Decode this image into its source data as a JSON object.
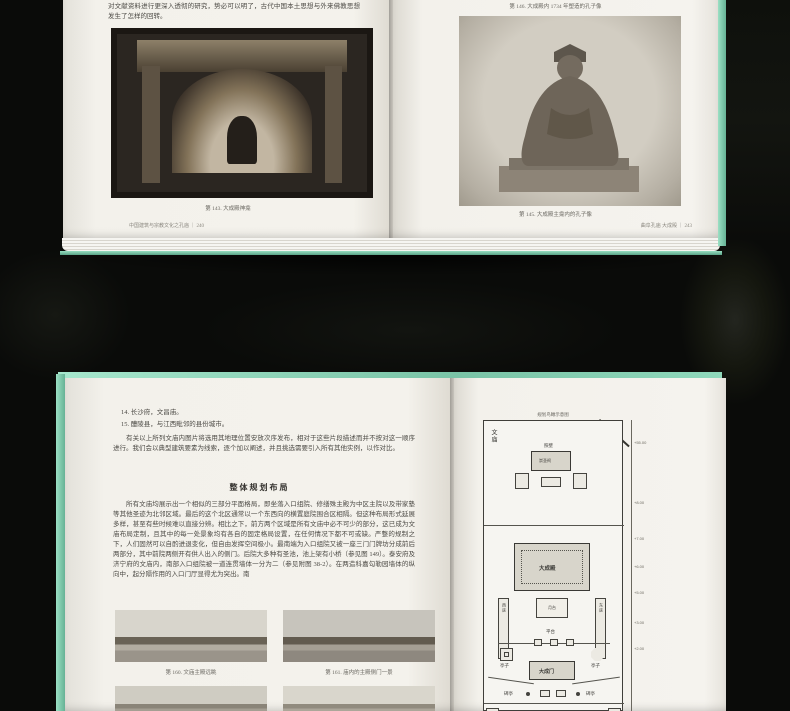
{
  "scene": {
    "background_color": "#0a0b09",
    "cover_color": "#8fd8bb",
    "page_color": "#f2f0ea"
  },
  "top_book": {
    "left_page": {
      "intro_text": "对文献资料进行更深入透彻的研究，势必可以明了，古代中国本土思想与外来佛教思想发生了怎样的回转。",
      "photo_caption": "第 143. 大成殿神龛",
      "footer": "中国建筑与宗教文化之孔庙 ｜ 240"
    },
    "right_page": {
      "top_caption": "第 146. 大成殿内 1734 年塑造的孔子像",
      "photo_caption": "第 145. 大成殿主龛内的孔子像",
      "footer": "曲阜孔庙 大成殿 ｜ 243"
    }
  },
  "bottom_book": {
    "left_page": {
      "list_items": [
        "14. 长沙府，文昌庙。",
        "15. 醴陵县，与江西毗邻的县份城市。"
      ],
      "intro_paragraph": "有关以上所列文庙内图片将选用其地理位置安放次序发布，相对于这些片段描述而并不按对这一顺序进行。我们会以典型建筑要素为线索，逐个加以阐述，并且挑选需要引入所有其他实例，以作对比。",
      "section_heading": "整体规划布局",
      "body_paragraph": "所有文庙均展示出一个相似的三部分平面格局，即坐落入口组院、修缮殊主殿为中区主院以及带家塾等其他圣迹为北邻区域。最后的这个北区通常以一个东西向的横置庭院围合区相隔。但这种布局形式延展多样，甚至有些时候难以直接分辨。相比之下，前方两个区域是所有文庙中必不可少的部分，这已成为文庙布局定制，且其中的每一处景象均有各自的固定格局设置，在任何情况下都不可或缺。严整的规制之下，人们固然可以自酌进退变化，但自由发挥空间极小。最南端为入口组院又被一座三门门牌坊分成前后两部分，其中前院两侧开有供人出入的侧门。后院大多种有圣池，池上架有小桥（参见图 149）。泰安府及济宁府的文庙内，南部入口组院被一道连贯墙体一分为二（参见附图 38-2）。在两造科嘉勾勒园墙体的纵向中，起分隔作用的入口门厅显得尤为突出。南",
      "photo_captions": [
        "第 160. 文庙主殿远眺",
        "第 161. 庙内的主殿侧门一景"
      ]
    },
    "right_page": {
      "plan": {
        "title": "规划鸟瞰示意图",
        "left_label": "文庙",
        "right_label": "泸州",
        "labels": {
          "screen_wall": "照壁",
          "shrine": "崇圣祠",
          "main_hall": "大成殿",
          "moon_terrace": "月台",
          "platform": "平台",
          "west_hall": "西庑",
          "east_hall": "东庑",
          "pavilion": "亭子",
          "gate": "大成门",
          "stele_pavilion": "碑亭"
        },
        "elevations": [
          "+55.00",
          "+8.00",
          "+7.00",
          "+6.00",
          "+5.00",
          "+3.00",
          "+2.00"
        ]
      }
    }
  }
}
